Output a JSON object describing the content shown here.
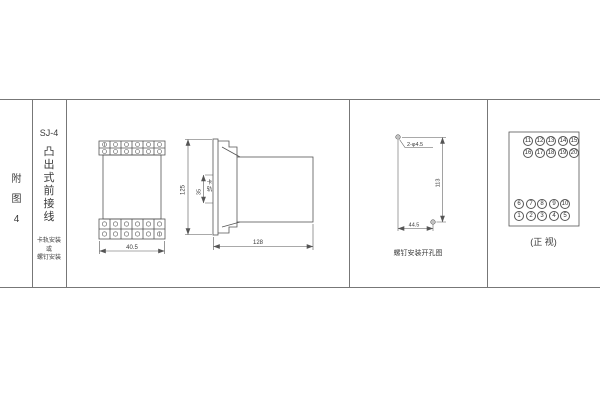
{
  "page": {
    "background_color": "#ffffff",
    "line_color": "#666666",
    "drawing_line_color": "#555555",
    "text_color": "#333333"
  },
  "index_column": {
    "label": "附图4"
  },
  "model_column": {
    "model": "SJ-4",
    "type_label": "凸出式前接线",
    "mounting_note": "卡轨安装\n或\n螺钉安装"
  },
  "front_view": {
    "width_dim": "40.5"
  },
  "side_view": {
    "height_dim": "125",
    "rail_width_dim": "35",
    "rail_label": "卡轨",
    "depth_dim": "128"
  },
  "drill_view": {
    "holes_label": "2-φ4.5",
    "vertical_dim": "113",
    "horizontal_dim": "44.5",
    "caption": "螺钉安装开孔图"
  },
  "terminal_view": {
    "caption": "(正 视)",
    "top_block": [
      [
        "11",
        "12",
        "13",
        "14",
        "15"
      ],
      [
        "16",
        "17",
        "18",
        "19",
        "20"
      ]
    ],
    "bottom_block": [
      [
        "6",
        "7",
        "8",
        "9",
        "10"
      ],
      [
        "1",
        "2",
        "3",
        "4",
        "5"
      ]
    ]
  }
}
